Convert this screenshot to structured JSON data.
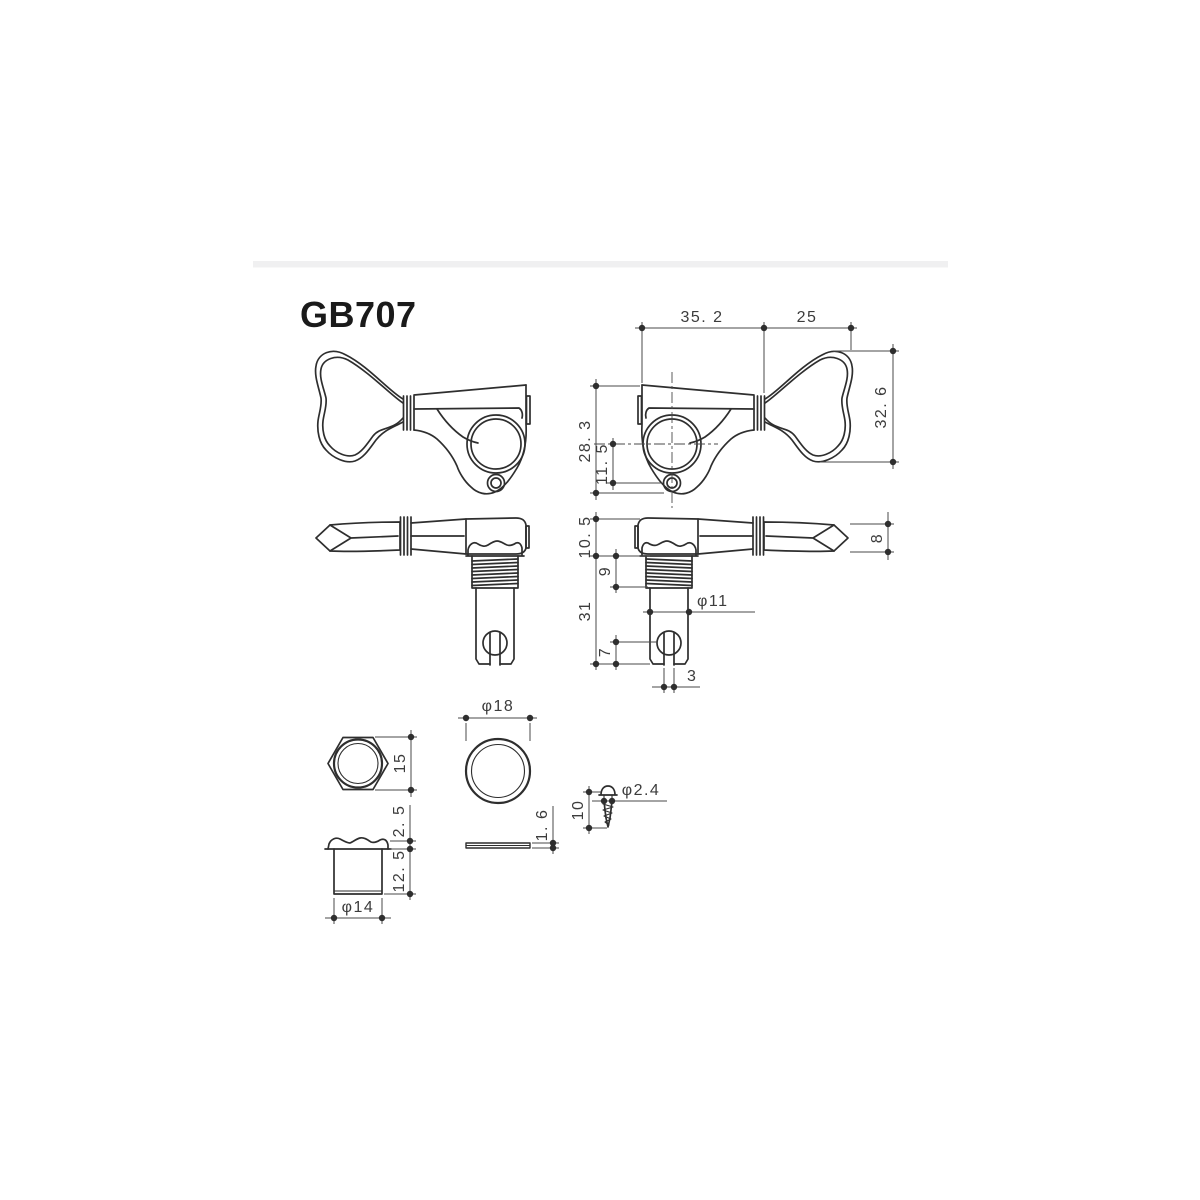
{
  "title": "GB707",
  "colors": {
    "line": "#2e2e2e",
    "dim_text": "#3c3c3c",
    "top_band": "#f0f0f1",
    "background": "#ffffff"
  },
  "dimensions": {
    "top_view": {
      "width_left": "35. 2",
      "width_right": "25",
      "total_height": "32. 6",
      "housing_height": "28. 3",
      "screw_hole_offset": "11. 5"
    },
    "side_view": {
      "housing_depth": "10. 5",
      "thread_length": "9",
      "post_length": "31",
      "post_diameter": "φ11",
      "slot_depth": "7",
      "slot_width": "3",
      "key_thickness": "8"
    },
    "hex_nut": {
      "across_flats": "15"
    },
    "bushing": {
      "flange_height": "2. 5",
      "body_height": "12. 5",
      "diameter": "φ14"
    },
    "washer": {
      "diameter": "φ18",
      "thickness": "1. 6"
    },
    "screw": {
      "length": "10",
      "diameter": "φ2.4"
    }
  }
}
